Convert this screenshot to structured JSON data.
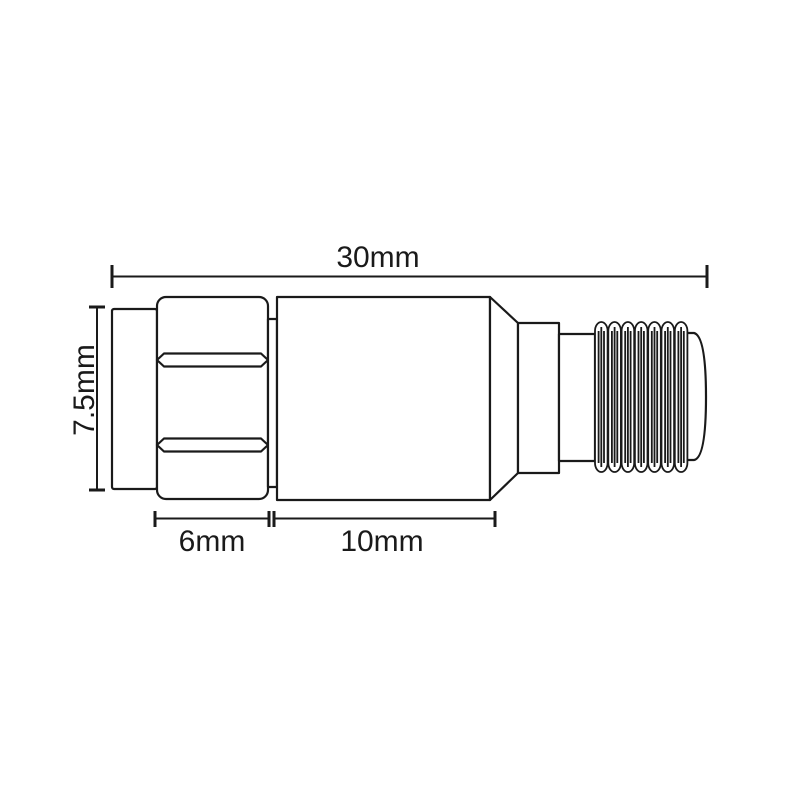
{
  "drawing": {
    "labels": {
      "overall_length": "30mm",
      "overall_height": "7.5mm",
      "hex_nut_length": "6mm",
      "body_length": "10mm"
    },
    "colors": {
      "line": "#1a1a1a",
      "fill": "#ffffff",
      "background": "#ffffff"
    }
  }
}
